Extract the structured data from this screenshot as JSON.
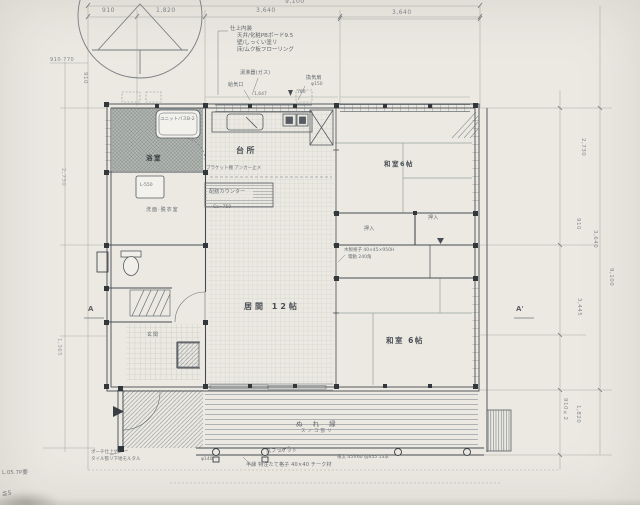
{
  "dimensions": {
    "top": {
      "overall": "9,100",
      "segments": [
        "910",
        "1,820",
        "3,640",
        "3,640"
      ]
    },
    "right": {
      "r1": "2,730",
      "r2": "910",
      "r3": "3,640",
      "overall": "9,100",
      "r4": "3,445",
      "r5": "910×2",
      "r6": "1,820"
    },
    "left": {
      "l1": "910·770",
      "l2": "910",
      "l3": "2,730",
      "l4": "1,365"
    }
  },
  "markers": {
    "a": "A",
    "a_prime": "A'"
  },
  "spec_block": {
    "title": "仕上内装",
    "line1": "天井/化粧PBボード9.5",
    "line2": "壁/しっくい塗リ",
    "line3": "床/ムク板フローリング"
  },
  "rooms": {
    "bath": "浴室",
    "bath_unit": "ユニットバスB-2",
    "laundry": "L-550",
    "washroom": "洗面·脱衣室",
    "entrance": "玄関",
    "kitchen": "台所",
    "living": "居間 12帖",
    "tatami_top": "和室6帖",
    "tatami_bottom": "和室 6帖",
    "closet_top": "押入",
    "closet_mid": "押入",
    "deck": "ぬ れ 縁",
    "deck_sub": "スノコ張リ"
  },
  "notes": {
    "gas": "湯沸器(ガス)",
    "intake": "給気口",
    "fan": "換気扇",
    "fan_dia": "φ150",
    "w1647": "1,647",
    "w780": "780",
    "counter": "配膳カウンター",
    "counter_h": "Ca=750",
    "bracket": "ブラケット棚 アンカー止メ",
    "lattice1": "木製格子 40×45×950H",
    "lattice2": "電動 240角",
    "deck0": "φ140",
    "deck1": "丸ブラケット",
    "deck2": "半縁 特注たて格子 40×40 チーク材",
    "deck3": "根太 45×60 @455 13本",
    "porch1": "ポーチ仕上ゲ/",
    "porch2": "タイル張リ下地モルタル",
    "hand1": "L.05.7P要",
    "hand2": "≦5"
  },
  "colors": {
    "paper": "#ebe9e2",
    "line": "#565b61",
    "wall": "#44494f",
    "text": "#5a5f66"
  }
}
